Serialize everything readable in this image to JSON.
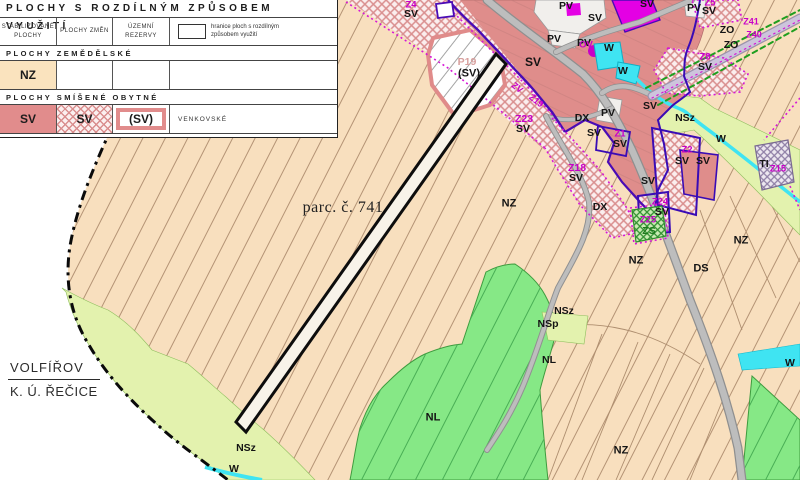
{
  "legend": {
    "title": "PLOCHY S ROZDÍLNÝM ZPŮSOBEM VYUŽITÍ",
    "headers": {
      "stabilized": "STABILIZOVANÉ PLOCHY",
      "changes": "PLOCHY ZMĚN",
      "reserves": "ÚZEMNÍ REZERVY"
    },
    "boundary_note": "hranice ploch s rozdílným způsobem využití",
    "section_agri": {
      "heading": "PLOCHY ZEMĚDĚLSKÉ",
      "nz_label": "NZ"
    },
    "section_mixed": {
      "heading": "PLOCHY SMÍŠENÉ OBYTNÉ",
      "sv_stable": "SV",
      "sv_change": "SV",
      "sv_reserve": "(SV)",
      "note": "VENKOVSKÉ"
    }
  },
  "map": {
    "parcel_label": "parc. č. 741",
    "cadastral": {
      "municipality": "VOLFÍŘOV",
      "cadastre": "K. Ú. ŘEČICE"
    },
    "colors": {
      "nz_agricultural": "#F8DFBE",
      "sv_mixed_residential": "#DF8D8B",
      "nsz_greenery": "#E3F2AE",
      "nl_forest": "#86E886",
      "water": "#3FE4F2",
      "civic_magenta": "#E400E4",
      "zone_boundary_purple": "#4A0BB5",
      "change_zone_magenta": "#C800C8",
      "road_gray": "#BDBDBD"
    },
    "labels": [
      {
        "t": "SV",
        "x": 533,
        "y": 62,
        "s": 12
      },
      {
        "t": "SV",
        "x": 595,
        "y": 18
      },
      {
        "t": "SV",
        "x": 647,
        "y": 4
      },
      {
        "t": "SV",
        "x": 650,
        "y": 106
      },
      {
        "t": "SV",
        "x": 594,
        "y": 133
      },
      {
        "t": "SV",
        "x": 620,
        "y": 144
      },
      {
        "t": "SV",
        "x": 648,
        "y": 181
      },
      {
        "t": "SV",
        "x": 576,
        "y": 178
      },
      {
        "t": "SV",
        "x": 523,
        "y": 129
      },
      {
        "t": "SV",
        "x": 411,
        "y": 14
      },
      {
        "t": "SV",
        "x": 709,
        "y": 11
      },
      {
        "t": "SV",
        "x": 705,
        "y": 67
      },
      {
        "t": "SV",
        "x": 682,
        "y": 161
      },
      {
        "t": "SV",
        "x": 703,
        "y": 161
      },
      {
        "t": "SV",
        "x": 662,
        "y": 212
      },
      {
        "t": "(SV)",
        "x": 469,
        "y": 74,
        "s": 11
      },
      {
        "t": "P19",
        "x": 467,
        "y": 62,
        "c": "#D8A09E"
      },
      {
        "t": "PV",
        "x": 566,
        "y": 6
      },
      {
        "t": "PV",
        "x": 554,
        "y": 39
      },
      {
        "t": "PV",
        "x": 584,
        "y": 43
      },
      {
        "t": "PV",
        "x": 608,
        "y": 113
      },
      {
        "t": "PV",
        "x": 694,
        "y": 8
      },
      {
        "t": "W",
        "x": 609,
        "y": 48
      },
      {
        "t": "W",
        "x": 623,
        "y": 71
      },
      {
        "t": "W",
        "x": 721,
        "y": 139
      },
      {
        "t": "W",
        "x": 790,
        "y": 363
      },
      {
        "t": "W",
        "x": 234,
        "y": 469
      },
      {
        "t": "DX",
        "x": 582,
        "y": 118
      },
      {
        "t": "DX",
        "x": 600,
        "y": 207
      },
      {
        "t": "DS",
        "x": 701,
        "y": 269,
        "s": 11
      },
      {
        "t": "NZ",
        "x": 509,
        "y": 204,
        "s": 11
      },
      {
        "t": "NZ",
        "x": 636,
        "y": 261,
        "s": 11
      },
      {
        "t": "NZ",
        "x": 741,
        "y": 241,
        "s": 11
      },
      {
        "t": "NZ",
        "x": 621,
        "y": 451,
        "s": 11
      },
      {
        "t": "NSz",
        "x": 685,
        "y": 118
      },
      {
        "t": "NSz",
        "x": 564,
        "y": 311
      },
      {
        "t": "NSz",
        "x": 246,
        "y": 448
      },
      {
        "t": "NSp",
        "x": 548,
        "y": 324
      },
      {
        "t": "NL",
        "x": 433,
        "y": 418,
        "s": 11
      },
      {
        "t": "NL",
        "x": 549,
        "y": 360
      },
      {
        "t": "TI",
        "x": 764,
        "y": 164
      },
      {
        "t": "ZS",
        "x": 649,
        "y": 231,
        "c": "#1E7A1E"
      },
      {
        "t": "ZO",
        "x": 727,
        "y": 30
      },
      {
        "t": "ZO",
        "x": 731,
        "y": 45
      },
      {
        "t": "Z4",
        "x": 411,
        "y": 5,
        "c": "#C800C8",
        "s": 9.5
      },
      {
        "t": "Z5",
        "x": 710,
        "y": 3,
        "c": "#C800C8",
        "s": 9.5
      },
      {
        "t": "Z8",
        "x": 705,
        "y": 57,
        "c": "#C800C8",
        "s": 9.5
      },
      {
        "t": "Z18",
        "x": 577,
        "y": 168,
        "c": "#C800C8",
        "s": 10.5
      },
      {
        "t": "Z23",
        "x": 524,
        "y": 119,
        "c": "#C800C8",
        "s": 10.5
      },
      {
        "t": "Z1",
        "x": 620,
        "y": 134,
        "c": "#C800C8",
        "s": 9.5
      },
      {
        "t": "Z2",
        "x": 687,
        "y": 150,
        "c": "#C800C8",
        "s": 9.5
      },
      {
        "t": "Z24",
        "x": 660,
        "y": 202,
        "c": "#C800C8",
        "s": 9.5
      },
      {
        "t": "Z25",
        "x": 648,
        "y": 220,
        "c": "#C800C8",
        "s": 9.5
      },
      {
        "t": "Z15",
        "x": 778,
        "y": 169,
        "c": "#C800C8",
        "s": 9.5
      },
      {
        "t": "Z41",
        "x": 751,
        "y": 22,
        "c": "#C800C8",
        "s": 9
      },
      {
        "t": "Z40",
        "x": 754,
        "y": 35,
        "c": "#C800C8",
        "s": 9
      },
      {
        "t": "OV",
        "x": 586,
        "y": 45,
        "c": "#C800C8",
        "s": 9.5
      },
      {
        "t": "ZV",
        "x": 517,
        "y": 88,
        "c": "#C800C8",
        "s": 9,
        "r": 38
      },
      {
        "t": "Z19",
        "x": 536,
        "y": 101,
        "c": "#C800C8",
        "s": 9,
        "r": 38
      },
      {
        "t": "parc. č. 741",
        "x": 343,
        "y": 208,
        "s": 16,
        "f": 1,
        "c": "#222222",
        "w": 400
      }
    ]
  }
}
